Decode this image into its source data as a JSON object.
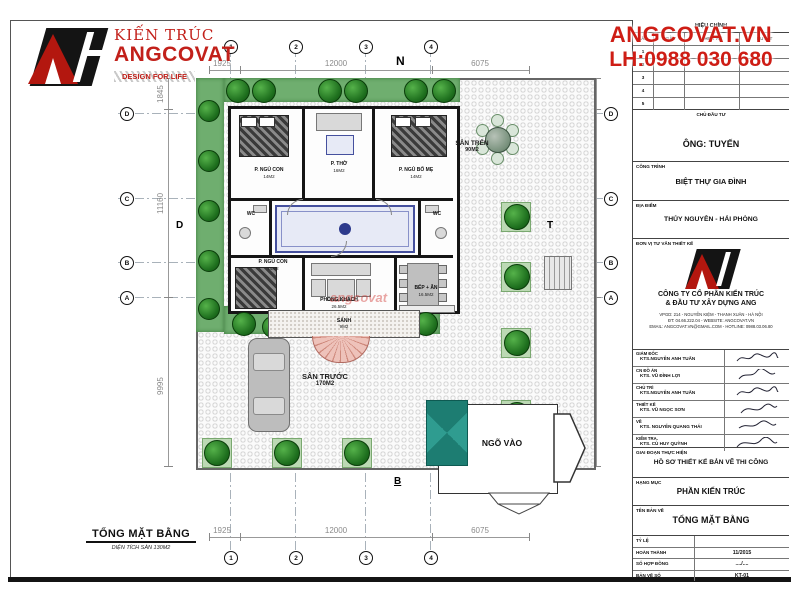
{
  "brand": {
    "kien_truc": "KIẾN TRÚC",
    "name": "ANGCOVAT",
    "tagline": "DESIGN FOR LIFE"
  },
  "contact": {
    "website": "ANGCOVAT.VN",
    "phone": "LH:0988 030 680"
  },
  "watermark": "angcovat",
  "plan": {
    "directions": {
      "top": "N",
      "bottom": "B",
      "left": "D",
      "right": "T"
    },
    "axes": {
      "cols": [
        "1",
        "2",
        "3",
        "4"
      ],
      "rows": [
        "D",
        "C",
        "B",
        "A"
      ]
    },
    "dims": {
      "horizontal": [
        "1925",
        "12000",
        "6075"
      ],
      "vertical": [
        "1845",
        "11160",
        "9995"
      ]
    },
    "rooms": [
      {
        "name": "P. NGỦ CON",
        "area": "14M2"
      },
      {
        "name": "P. THỜ",
        "area": "16M2"
      },
      {
        "name": "P. NGỦ BỐ MẸ",
        "area": "14M2"
      },
      {
        "name": "WC",
        "area": ""
      },
      {
        "name": "WC",
        "area": ""
      },
      {
        "name": "P. NGỦ CON",
        "area": "14M2"
      },
      {
        "name": "PHÒNG KHÁCH",
        "area": "26.5M2"
      },
      {
        "name": "BẾP + ĂN",
        "area": "16.5M2"
      },
      {
        "name": "SẢNH",
        "area": "9M2"
      }
    ],
    "yards": {
      "san_tren": "SÂN TRÊN",
      "san_tren_area": "90M2",
      "san_truoc": "SÂN TRƯỚC",
      "san_truoc_area": "170M2",
      "ngo_vao": "NGÕ VÀO"
    }
  },
  "footer": {
    "title": "TỔNG MẶT BẰNG",
    "subtitle": "DIỆN TÍCH SÀN 130M2"
  },
  "titleblock": {
    "revision": {
      "title": "HIỆU CHỈNH",
      "columns": [
        "LẦN",
        "NGÀY",
        "THIẾT KẾ",
        "DUYỆT"
      ],
      "rows": [
        "1",
        "2",
        "3",
        "4",
        "5"
      ]
    },
    "fields": {
      "chu_dau_tu_label": "CHỦ ĐẦU TƯ",
      "chu_dau_tu": "ÔNG:  TUYẾN",
      "cong_trinh_label": "CÔNG TRÌNH",
      "cong_trinh": "BIỆT THỰ GIA ĐÌNH",
      "dia_diem_label": "ĐỊA ĐIỂM",
      "dia_diem": "THỦY NGUYÊN - HẢI PHÒNG",
      "don_vi_label": "ĐƠN VỊ TƯ VẤN THIẾT KẾ",
      "company_line1": "CÔNG TY CỔ PHẦN KIẾN TRÚC",
      "company_line2": "& ĐẦU TƯ XÂY DỰNG ANG",
      "addr": "VPGD: 214 - NGUYỄN KIỆM - THANH XUÂN - HÀ NỘI",
      "tel": "ĐT: 04.66.222.04 - WEBSITE: ANGCOVAT.VN",
      "email": "EMAIL: ANGCOVAT.VN@GMAIL.COM - HOTLINE: 0988.03.06.80",
      "giai_doan_label": "GIAI ĐOẠN THỰC HIỆN",
      "giai_doan": "HỒ SƠ THIẾT KẾ BẢN VẼ THI CÔNG",
      "hang_muc_label": "HẠNG MỤC",
      "hang_muc": "PHẦN KIẾN TRÚC",
      "ten_ban_ve_label": "TÊN BẢN VẼ",
      "ten_ban_ve": "TỔNG MẶT BẰNG",
      "ty_le_label": "TỶ LỆ",
      "ty_le": "",
      "hoan_thanh_label": "HOÀN THÀNH",
      "hoan_thanh": "11/2015",
      "so_hop_dong_label": "SỐ HỢP ĐỒNG",
      "so_hop_dong": "..../....",
      "ban_ve_so_label": "BẢN VẼ SỐ",
      "ban_ve_so": "KT-01"
    },
    "signatures": [
      {
        "role": "GIÁM ĐỐC",
        "name": "KTS.NGUYỄN ANH TUẤN"
      },
      {
        "role": "CN ĐỒ ÁN",
        "name": "KTS. VŨ ĐÌNH LỢI"
      },
      {
        "role": "CHỦ TRÌ",
        "name": "KTS.NGUYỄN ANH TUẤN"
      },
      {
        "role": "THIẾT KẾ",
        "name": "KTS. VŨ NGỌC SƠN"
      },
      {
        "role": "VẼ",
        "name": "KTS. NGUYỄN QUANG THÁI"
      },
      {
        "role": "KIỂM TRA.",
        "name": "KTS. CÙ HUY QUỲNH"
      }
    ]
  },
  "colors": {
    "brand_red": "#c2201a",
    "gate_teal": "#2f9c90",
    "tree_green": "#1e6f1e"
  }
}
